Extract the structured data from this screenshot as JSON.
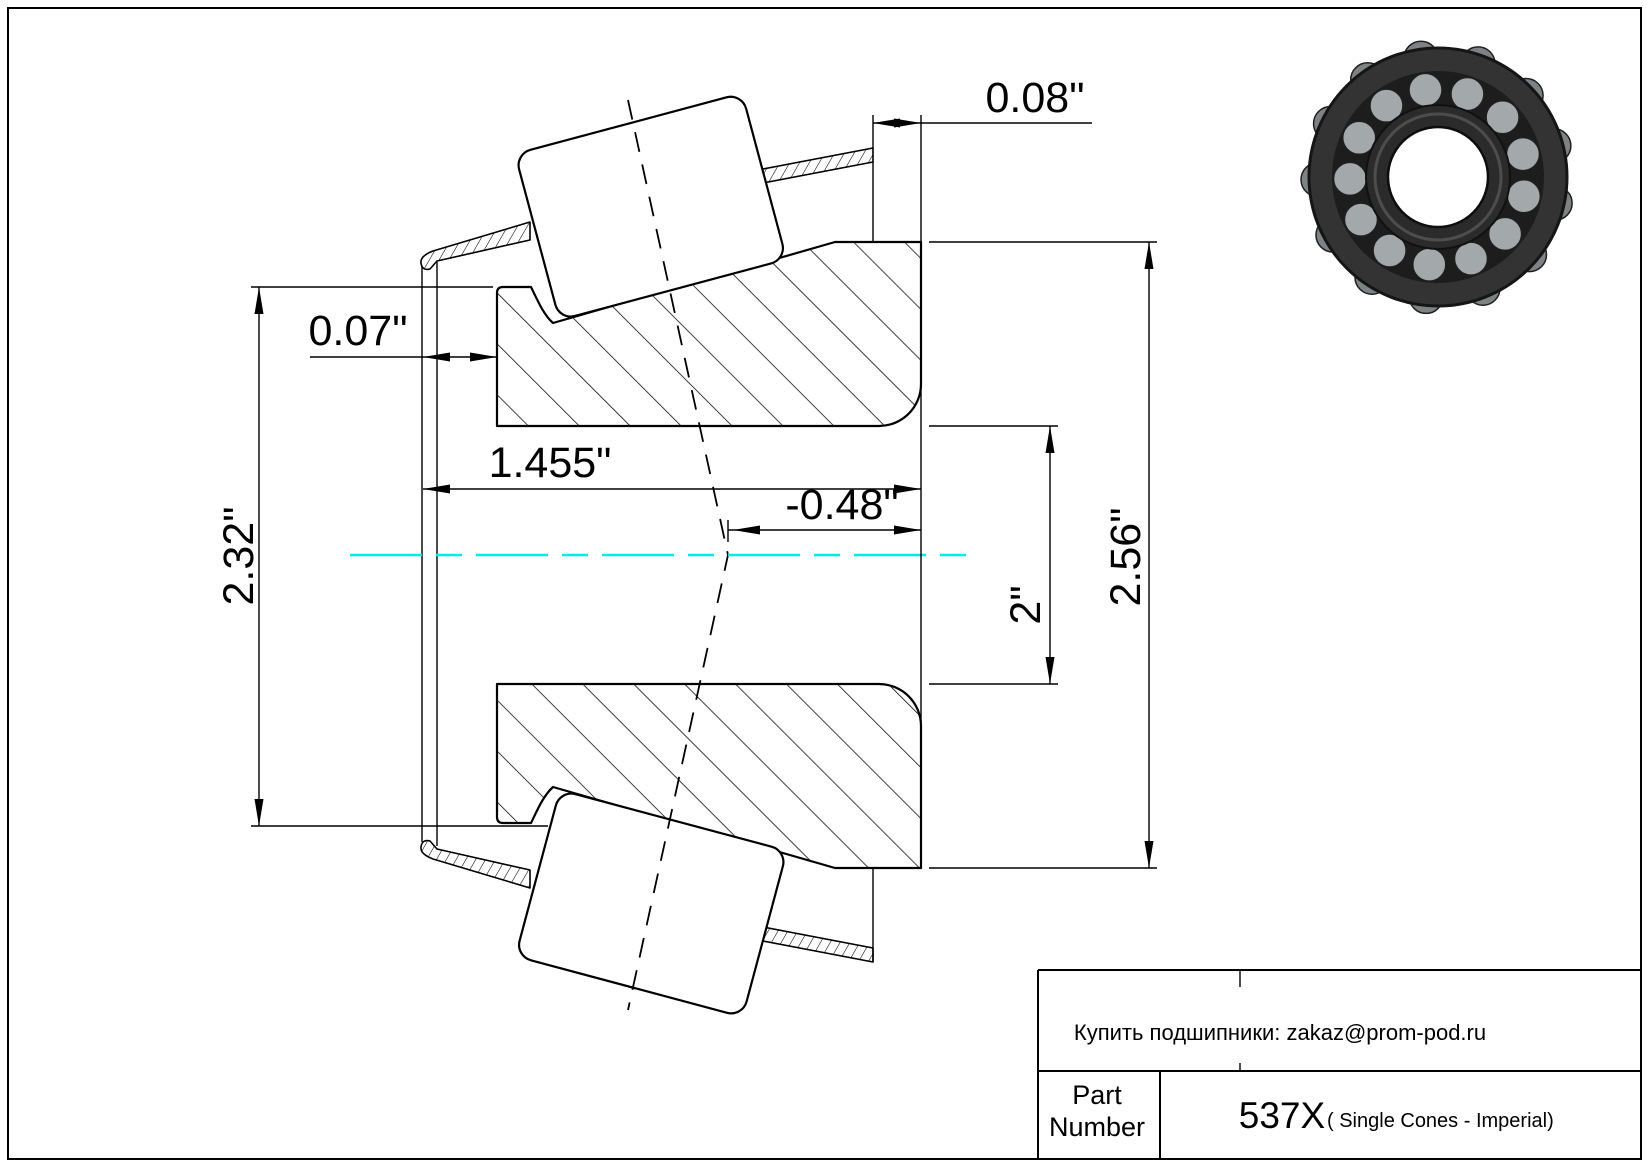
{
  "drawing": {
    "type": "bearing cone cross-section",
    "dims": {
      "cage_protrusion_right": "0.08\"",
      "cage_front_clearance": "0.07\"",
      "total_width": "1.455\"",
      "effective_load_center": "-0.48\"",
      "front_rib_diameter": "2.32\"",
      "bore_diameter": "2\"",
      "outer_race_diameter": "2.56\""
    },
    "centerline_color": "#00ebeb",
    "line_color": "#000000"
  },
  "title_block": {
    "contact": "Купить подшипники: zakaz@prom-pod.ru",
    "part_label_line1": "Part",
    "part_label_line2": "Number",
    "part_number": "537X",
    "series": "( Single Cones - Imperial)"
  },
  "bearing_photo": {
    "description": "tapered-roller-bearing-cone-photo",
    "roller_count": 13,
    "bump_count": 13,
    "body_color": "#333333",
    "dark_color": "#1d1d1d",
    "cage_color": "#2b2b2b",
    "roller_color": "#a3a8aa",
    "bump_color": "#7d8284",
    "bore_color": "#ffffff"
  }
}
